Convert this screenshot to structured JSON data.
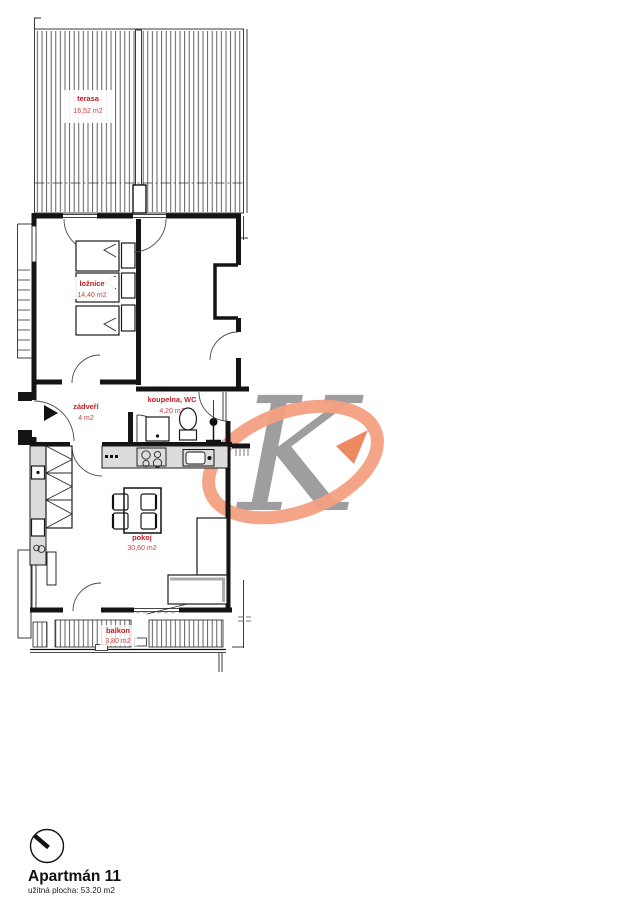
{
  "document": {
    "background": "#ffffff"
  },
  "plan": {
    "label_color": "#bf2026",
    "rooms": {
      "terasa": {
        "name": "terasa",
        "area": "16,52 m2"
      },
      "loznice": {
        "name": "ložnice",
        "area": "14,40 m2"
      },
      "zadveri": {
        "name": "zádveří",
        "area": "4 m2"
      },
      "koupelna": {
        "name": "koupelna, WC",
        "area": "4,20 m2"
      },
      "pokoj": {
        "name": "pokoj",
        "area": "30,60 m2"
      },
      "balkon": {
        "name": "balkon",
        "area": "3,80 m2"
      }
    }
  },
  "logo": {
    "letter": "K",
    "letter_color": "#96969a",
    "loop_color": "#f39f81",
    "arrow_color": "#ee8a62"
  },
  "footer": {
    "title": "Apartmán 11",
    "area_label": "užitná plocha: 53.20 m2"
  }
}
